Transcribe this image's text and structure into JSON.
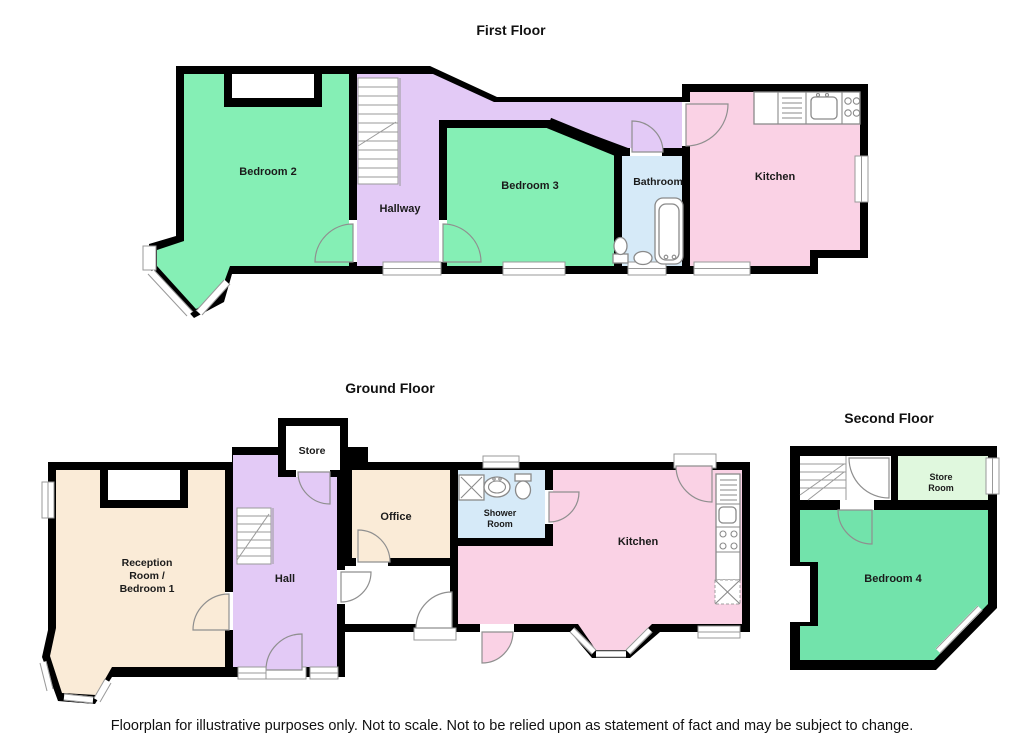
{
  "titles": {
    "first": "First Floor",
    "ground": "Ground Floor",
    "second": "Second Floor"
  },
  "disclaimer": "Floorplan for illustrative purposes only. Not to scale. Not to be relied upon as statement of fact and may be subject to change.",
  "colors": {
    "wall": "#000000",
    "bedroom_green": "#85EFB5",
    "bedroom4_green": "#72E3AB",
    "store_green": "#E0F8DE",
    "hall_purple": "#E3CAF6",
    "kitchen_pink": "#FAD2E5",
    "bath_blue": "#D6EAF8",
    "cream": "#FAEBD7",
    "corridor_white": "#FFFFFF"
  },
  "first_floor": {
    "rooms": {
      "bedroom2": "Bedroom 2",
      "hallway": "Hallway",
      "bedroom3": "Bedroom 3",
      "bathroom": "Bathroom",
      "kitchen": "Kitchen"
    }
  },
  "ground_floor": {
    "rooms": {
      "reception_line1": "Reception",
      "reception_line2": "Room /",
      "reception_line3": "Bedroom 1",
      "hall": "Hall",
      "store": "Store",
      "office": "Office",
      "shower_line1": "Shower",
      "shower_line2": "Room",
      "kitchen": "Kitchen"
    }
  },
  "second_floor": {
    "rooms": {
      "store_line1": "Store",
      "store_line2": "Room",
      "bedroom4": "Bedroom 4"
    }
  }
}
